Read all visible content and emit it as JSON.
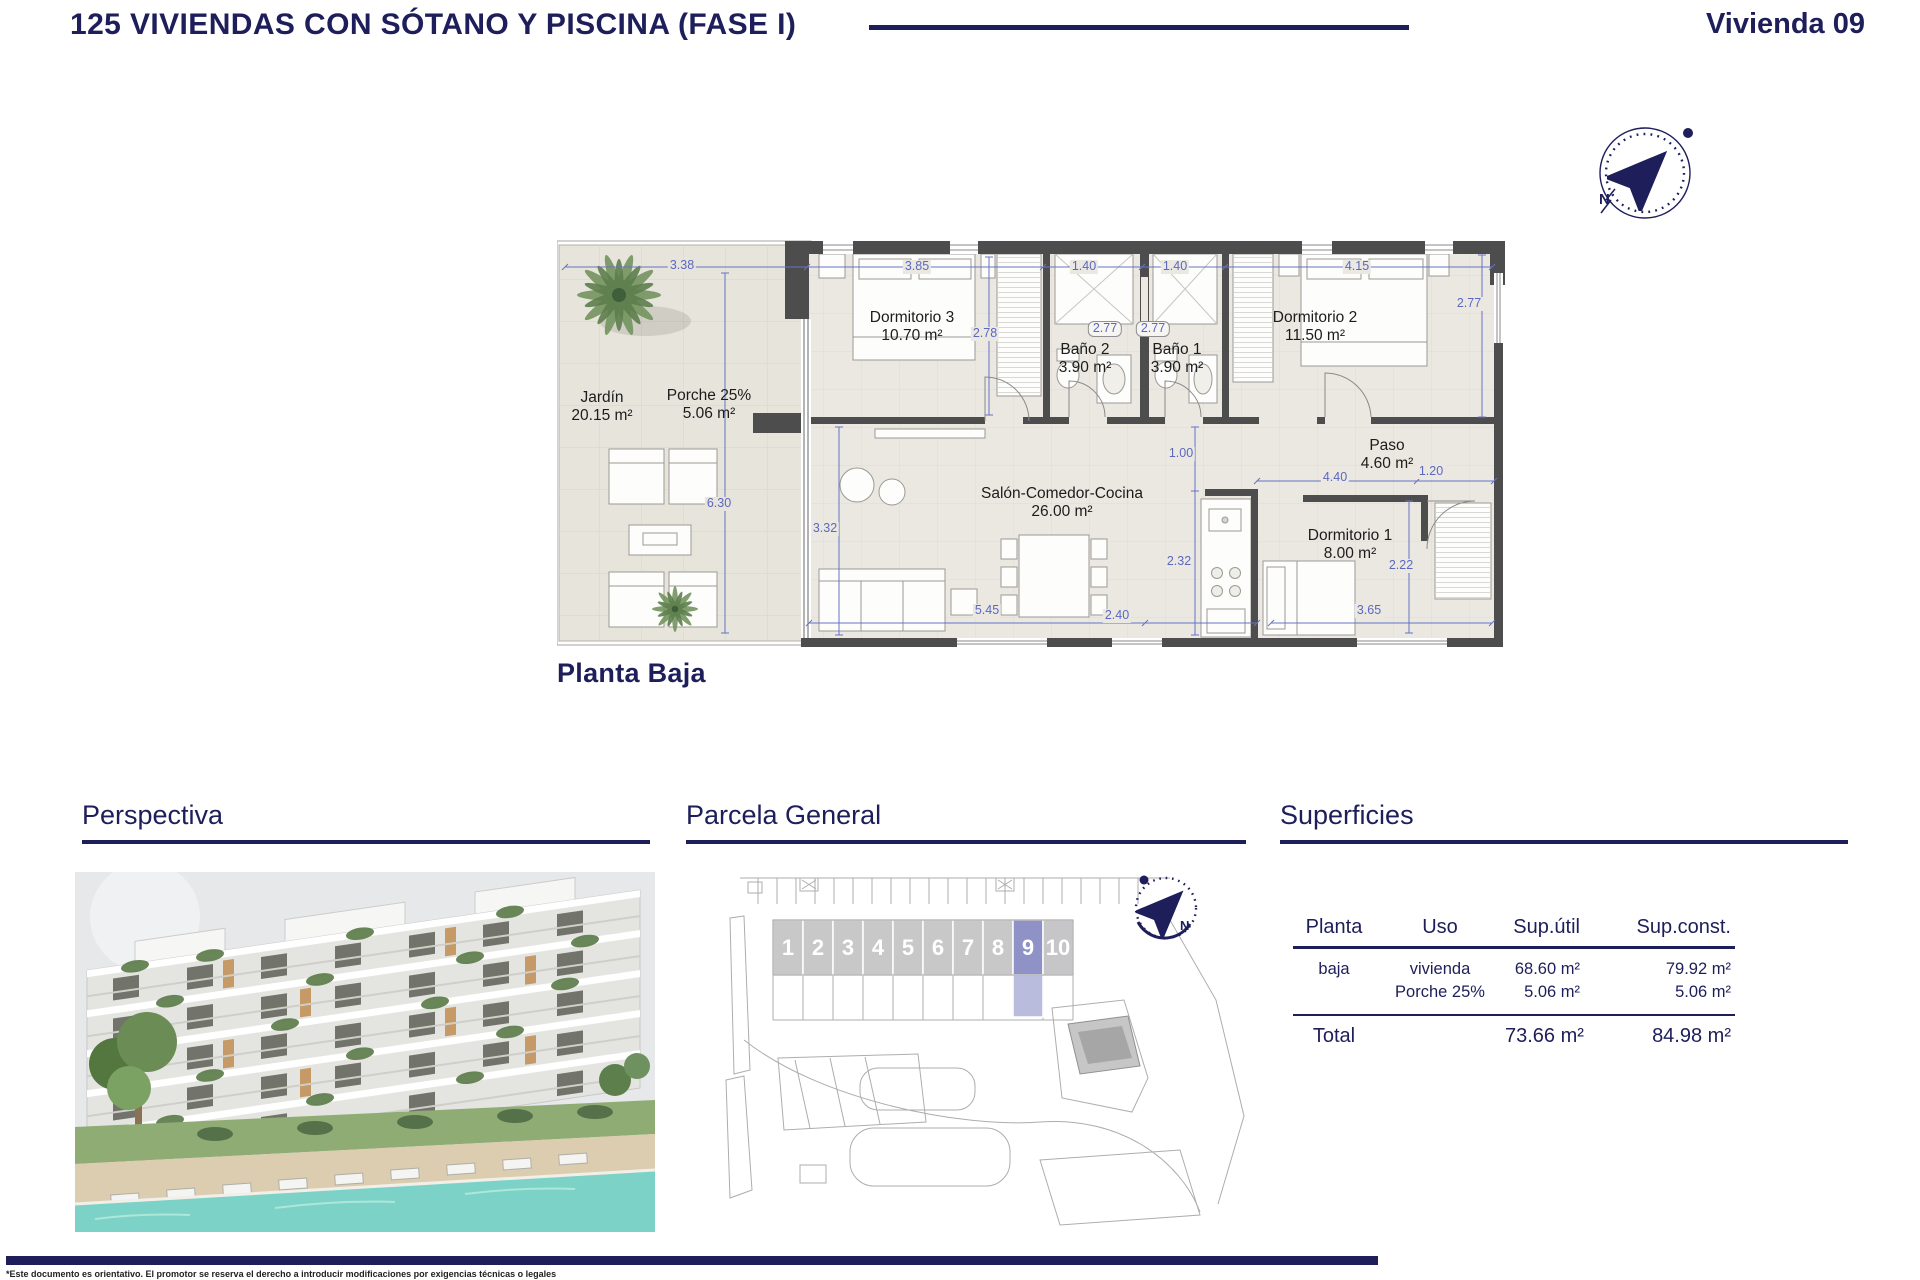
{
  "header": {
    "title": "125 VIVIENDAS CON SÓTANO Y PISCINA (FASE I)",
    "unit_label": "Vivienda 09"
  },
  "compass": {
    "north_label": "N"
  },
  "floorplan": {
    "caption": "Planta Baja",
    "rooms": [
      {
        "name": "Jardín",
        "area": "20.15 m²"
      },
      {
        "name": "Porche 25%",
        "area": "5.06 m²"
      },
      {
        "name": "Dormitorio 3",
        "area": "10.70 m²"
      },
      {
        "name": "Baño 2",
        "area": "3.90 m²"
      },
      {
        "name": "Baño 1",
        "area": "3.90 m²"
      },
      {
        "name": "Dormitorio 2",
        "area": "11.50 m²"
      },
      {
        "name": "Salón-Comedor-Cocina",
        "area": "26.00 m²"
      },
      {
        "name": "Paso",
        "area": "4.60 m²"
      },
      {
        "name": "Dormitorio 1",
        "area": "8.00 m²"
      }
    ],
    "dimensions": [
      "3.38",
      "3.85",
      "1.40",
      "1.40",
      "4.15",
      "2.78",
      "2.77",
      "2.77",
      "2.77",
      "6.30",
      "3.32",
      "1.00",
      "4.40",
      "1.20",
      "2.32",
      "2.22",
      "5.45",
      "2.40",
      "3.65"
    ]
  },
  "sections": {
    "perspectiva": {
      "title": "Perspectiva"
    },
    "parcela": {
      "title": "Parcela General",
      "units": [
        "1",
        "2",
        "3",
        "4",
        "5",
        "6",
        "7",
        "8",
        "9",
        "10"
      ],
      "highlighted_unit": "9",
      "north_label": "N"
    },
    "superficies": {
      "title": "Superficies",
      "table": {
        "headers": [
          "Planta",
          "Uso",
          "Sup.útil",
          "Sup.const."
        ],
        "rows": [
          {
            "planta": "baja",
            "uso": "vivienda",
            "sup_util": "68.60 m²",
            "sup_const": "79.92 m²"
          },
          {
            "planta": "",
            "uso": "Porche 25%",
            "sup_util": "5.06 m²",
            "sup_const": "5.06 m²"
          }
        ],
        "total": {
          "label": "Total",
          "sup_util": "73.66 m²",
          "sup_const": "84.98 m²"
        }
      }
    }
  },
  "footer": {
    "disclaimer": "*Este documento es orientativo. El promotor se reserva el derecho a introducir modificaciones por exigencias técnicas o legales"
  },
  "colors": {
    "navy": "#1d1e5a",
    "dimension_blue": "#5b68c0",
    "wall_gray": "#4d4d4d",
    "floor_tile": "#ebe8e2",
    "unit_gray": "#c8c8c8",
    "unit_highlight": "#8e92c6",
    "pool": "#7cd2c6"
  }
}
